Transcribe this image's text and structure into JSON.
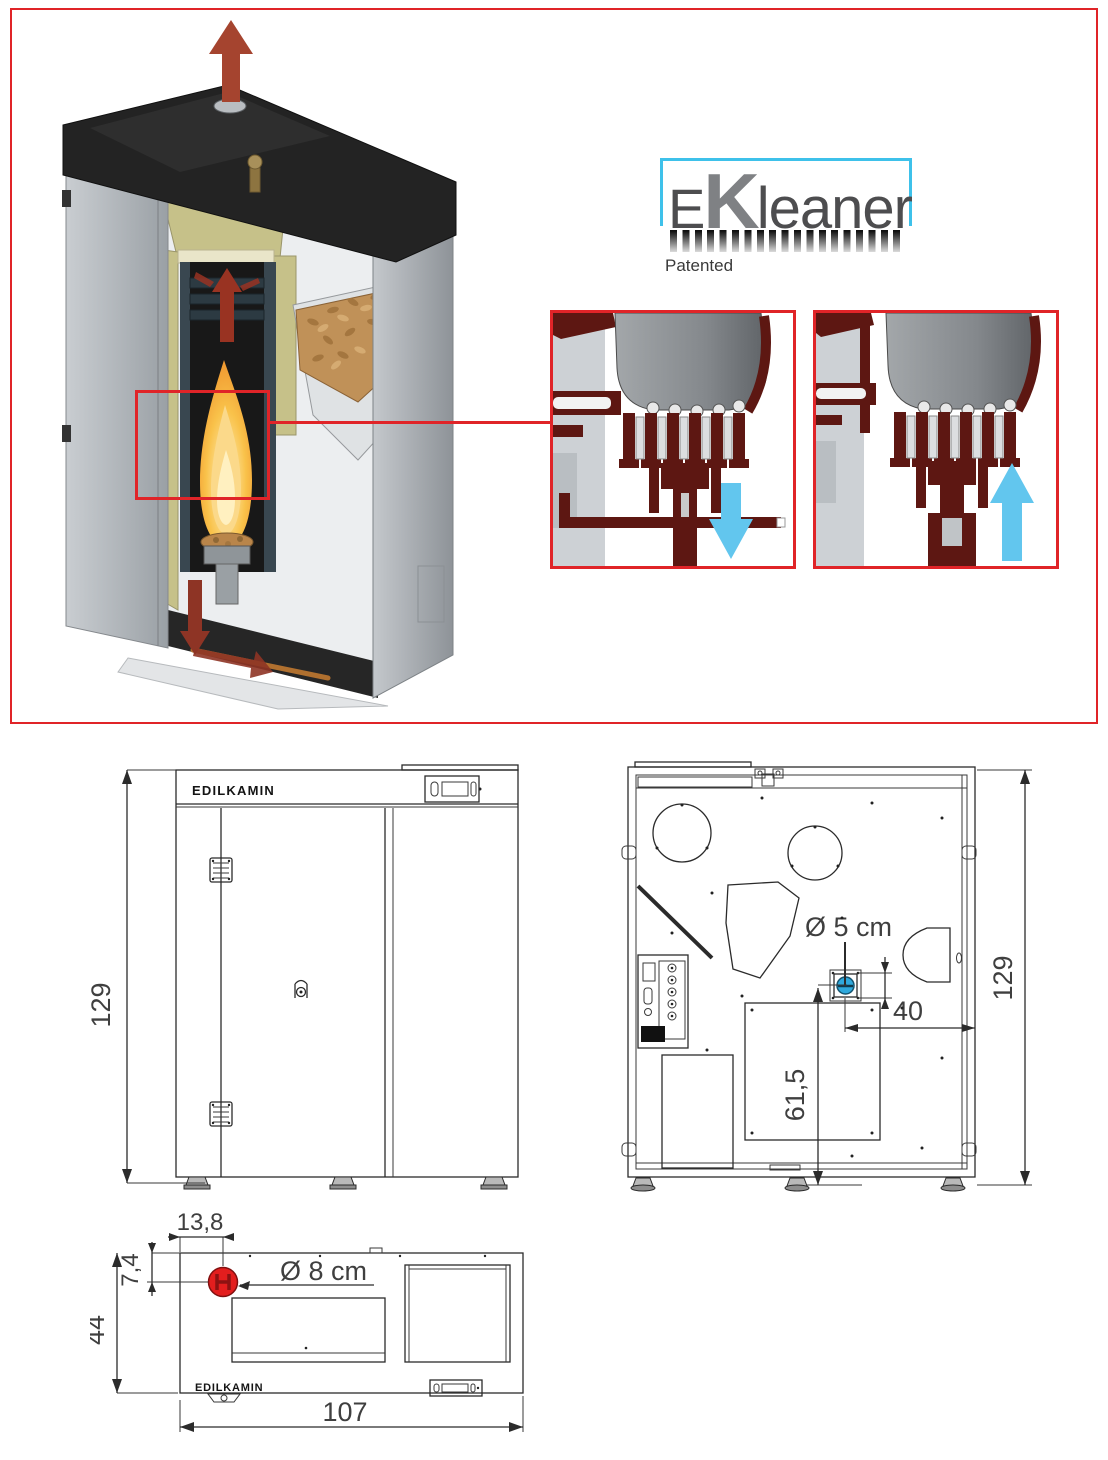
{
  "hero": {
    "logo": {
      "e": "E",
      "k": "K",
      "rest": "leaner",
      "patented": "Patented"
    },
    "colors": {
      "frame_red": "#e02428",
      "arrow_dark_red": "#a5442f",
      "detail_maroon": "#5d1712",
      "detail_arrow_blue": "#62c6ee",
      "insulation_olive": "#c6c189",
      "pellet_brown": "#c09158"
    }
  },
  "front_view": {
    "brand": "EDILKAMIN",
    "height": "129"
  },
  "back_view": {
    "height": "129",
    "port_diameter": "Ø 5 cm",
    "port_offset_right": "40",
    "port_offset_bottom": "61,5",
    "port_color": "#2fa9dd"
  },
  "top_view": {
    "brand": "EDILKAMIN",
    "flue_diameter": "Ø 8 cm",
    "flue_offset_x": "13,8",
    "flue_offset_y": "7,4",
    "depth": "44",
    "width": "107",
    "flue_color": "#e31e1e"
  }
}
